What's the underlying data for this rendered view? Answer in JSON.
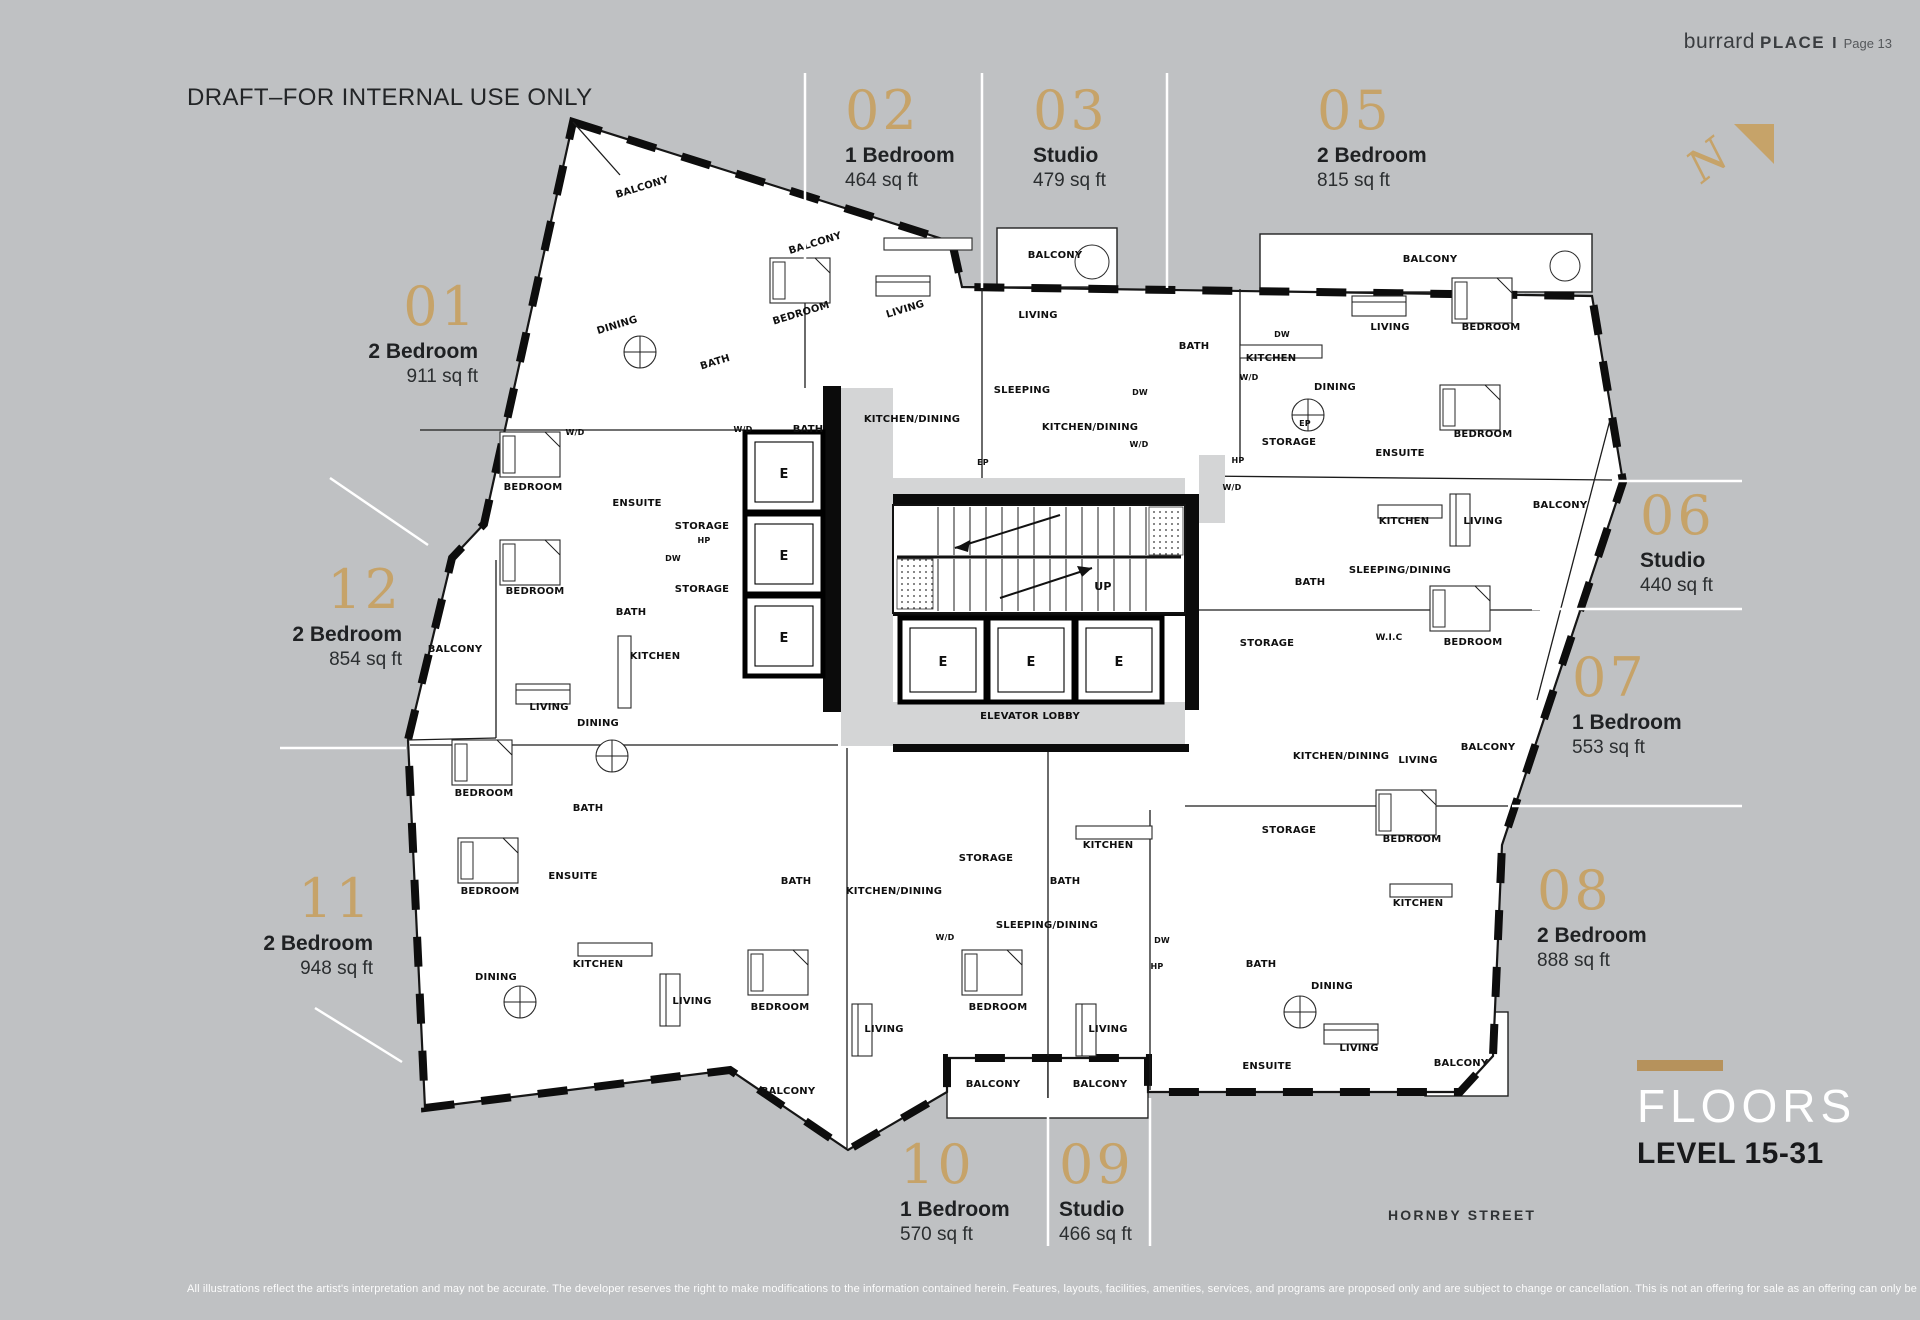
{
  "page": {
    "brand": {
      "light": "burrard",
      "bold": "PLACE",
      "sep": "I",
      "page_label": "Page 13"
    },
    "draft_notice": "DRAFT–FOR INTERNAL USE ONLY",
    "street_label": "HORNBY STREET",
    "floors": {
      "title": "FLOORS",
      "subtitle": "LEVEL 15-31"
    },
    "disclaimer": "All illustrations reflect the artist's interpretation and may not be accurate. The developer reserves the right to make modifications to the information contained herein. Features, layouts, facilities, amenities, services, and programs are proposed only and are subject to change or cancellation. This is not an offering for sale as an offering can only be made by disclosure statement. E.&O.E.",
    "colors": {
      "background": "#bfc1c3",
      "gold": "#c6a369",
      "ink": "#161616",
      "plan_fill": "#ffffff",
      "corridor": "#d4d5d6",
      "floors_bar": "#b6925c"
    }
  },
  "units": [
    {
      "number": "01",
      "type": "2 Bedroom",
      "area": "911 sq ft"
    },
    {
      "number": "02",
      "type": "1 Bedroom",
      "area": "464 sq ft"
    },
    {
      "number": "03",
      "type": "Studio",
      "area": "479 sq ft"
    },
    {
      "number": "05",
      "type": "2 Bedroom",
      "area": "815 sq ft"
    },
    {
      "number": "06",
      "type": "Studio",
      "area": "440 sq ft"
    },
    {
      "number": "07",
      "type": "1 Bedroom",
      "area": "553 sq ft"
    },
    {
      "number": "08",
      "type": "2 Bedroom",
      "area": "888 sq ft"
    },
    {
      "number": "09",
      "type": "Studio",
      "area": "466 sq ft"
    },
    {
      "number": "10",
      "type": "1 Bedroom",
      "area": "570 sq ft"
    },
    {
      "number": "11",
      "type": "2 Bedroom",
      "area": "948 sq ft"
    },
    {
      "number": "12",
      "type": "2 Bedroom",
      "area": "854 sq ft"
    }
  ],
  "plan": {
    "north_label": "N",
    "room_labels": [
      {
        "t": "BALCONY",
        "x": 643,
        "y": 190,
        "r": -17
      },
      {
        "t": "BALCONY",
        "x": 816,
        "y": 246,
        "r": -17
      },
      {
        "t": "BALCONY",
        "x": 1055,
        "y": 258
      },
      {
        "t": "BALCONY",
        "x": 1430,
        "y": 262
      },
      {
        "t": "BALCONY",
        "x": 1560,
        "y": 508
      },
      {
        "t": "BALCONY",
        "x": 1488,
        "y": 750
      },
      {
        "t": "BALCONY",
        "x": 455,
        "y": 652
      },
      {
        "t": "BALCONY",
        "x": 788,
        "y": 1094
      },
      {
        "t": "BALCONY",
        "x": 993,
        "y": 1087
      },
      {
        "t": "BALCONY",
        "x": 1100,
        "y": 1087
      },
      {
        "t": "BALCONY",
        "x": 1461,
        "y": 1066
      },
      {
        "t": "BEDROOM",
        "x": 802,
        "y": 316,
        "r": -17
      },
      {
        "t": "BEDROOM",
        "x": 1491,
        "y": 330
      },
      {
        "t": "BEDROOM",
        "x": 1483,
        "y": 437
      },
      {
        "t": "BEDROOM",
        "x": 533,
        "y": 490
      },
      {
        "t": "BEDROOM",
        "x": 535,
        "y": 594
      },
      {
        "t": "BEDROOM",
        "x": 1473,
        "y": 645
      },
      {
        "t": "BEDROOM",
        "x": 484,
        "y": 796
      },
      {
        "t": "BEDROOM",
        "x": 490,
        "y": 894
      },
      {
        "t": "BEDROOM",
        "x": 1412,
        "y": 842
      },
      {
        "t": "BEDROOM",
        "x": 780,
        "y": 1010
      },
      {
        "t": "BEDROOM",
        "x": 998,
        "y": 1010
      },
      {
        "t": "LIVING",
        "x": 906,
        "y": 312,
        "r": -17
      },
      {
        "t": "LIVING",
        "x": 1038,
        "y": 318
      },
      {
        "t": "LIVING",
        "x": 1390,
        "y": 330
      },
      {
        "t": "LIVING",
        "x": 1483,
        "y": 524
      },
      {
        "t": "LIVING",
        "x": 549,
        "y": 710
      },
      {
        "t": "LIVING",
        "x": 1418,
        "y": 763
      },
      {
        "t": "LIVING",
        "x": 692,
        "y": 1004
      },
      {
        "t": "LIVING",
        "x": 884,
        "y": 1032
      },
      {
        "t": "LIVING",
        "x": 1108,
        "y": 1032
      },
      {
        "t": "LIVING",
        "x": 1359,
        "y": 1051
      },
      {
        "t": "KITCHEN",
        "x": 1271,
        "y": 361
      },
      {
        "t": "KITCHEN",
        "x": 1404,
        "y": 524
      },
      {
        "t": "KITCHEN",
        "x": 655,
        "y": 659
      },
      {
        "t": "KITCHEN",
        "x": 598,
        "y": 967
      },
      {
        "t": "KITCHEN",
        "x": 1108,
        "y": 848
      },
      {
        "t": "KITCHEN",
        "x": 1418,
        "y": 906
      },
      {
        "t": "DINING",
        "x": 618,
        "y": 328,
        "r": -17
      },
      {
        "t": "DINING",
        "x": 1335,
        "y": 390
      },
      {
        "t": "DINING",
        "x": 598,
        "y": 726
      },
      {
        "t": "DINING",
        "x": 496,
        "y": 980
      },
      {
        "t": "DINING",
        "x": 1332,
        "y": 989
      },
      {
        "t": "KITCHEN/DINING",
        "x": 912,
        "y": 422
      },
      {
        "t": "KITCHEN/DINING",
        "x": 1090,
        "y": 430
      },
      {
        "t": "KITCHEN/DINING",
        "x": 1341,
        "y": 759
      },
      {
        "t": "KITCHEN/DINING",
        "x": 894,
        "y": 894
      },
      {
        "t": "SLEEPING",
        "x": 1022,
        "y": 393
      },
      {
        "t": "SLEEPING/DINING",
        "x": 1400,
        "y": 573
      },
      {
        "t": "SLEEPING/DINING",
        "x": 1047,
        "y": 928
      },
      {
        "t": "BATH",
        "x": 716,
        "y": 365,
        "r": -17
      },
      {
        "t": "BATH",
        "x": 808,
        "y": 432
      },
      {
        "t": "BATH",
        "x": 1194,
        "y": 349
      },
      {
        "t": "BATH",
        "x": 1310,
        "y": 585
      },
      {
        "t": "BATH",
        "x": 631,
        "y": 615
      },
      {
        "t": "BATH",
        "x": 588,
        "y": 811
      },
      {
        "t": "BATH",
        "x": 796,
        "y": 884
      },
      {
        "t": "BATH",
        "x": 1065,
        "y": 884
      },
      {
        "t": "BATH",
        "x": 1261,
        "y": 967
      },
      {
        "t": "ENSUITE",
        "x": 637,
        "y": 506
      },
      {
        "t": "ENSUITE",
        "x": 1400,
        "y": 456
      },
      {
        "t": "ENSUITE",
        "x": 573,
        "y": 879
      },
      {
        "t": "ENSUITE",
        "x": 1267,
        "y": 1069
      },
      {
        "t": "STORAGE",
        "x": 702,
        "y": 529
      },
      {
        "t": "STORAGE",
        "x": 702,
        "y": 592
      },
      {
        "t": "STORAGE",
        "x": 1289,
        "y": 445
      },
      {
        "t": "STORAGE",
        "x": 1267,
        "y": 646
      },
      {
        "t": "STORAGE",
        "x": 986,
        "y": 861
      },
      {
        "t": "STORAGE",
        "x": 1289,
        "y": 833
      },
      {
        "t": "W/D",
        "x": 575,
        "y": 435,
        "s": 8
      },
      {
        "t": "W/D",
        "x": 743,
        "y": 432,
        "s": 8
      },
      {
        "t": "W/D",
        "x": 1139,
        "y": 447,
        "s": 8
      },
      {
        "t": "W/D",
        "x": 1249,
        "y": 380,
        "s": 8
      },
      {
        "t": "W/D",
        "x": 1232,
        "y": 490,
        "s": 8
      },
      {
        "t": "W/D",
        "x": 945,
        "y": 940,
        "s": 8
      },
      {
        "t": "DW",
        "x": 1282,
        "y": 337,
        "s": 8
      },
      {
        "t": "DW",
        "x": 1140,
        "y": 395,
        "s": 8
      },
      {
        "t": "DW",
        "x": 673,
        "y": 561,
        "s": 8
      },
      {
        "t": "DW",
        "x": 1162,
        "y": 943,
        "s": 8
      },
      {
        "t": "HP",
        "x": 704,
        "y": 543,
        "s": 8
      },
      {
        "t": "HP",
        "x": 1238,
        "y": 463,
        "s": 8
      },
      {
        "t": "HP",
        "x": 1157,
        "y": 969,
        "s": 8
      },
      {
        "t": "EP",
        "x": 1305,
        "y": 426,
        "s": 8
      },
      {
        "t": "EP",
        "x": 983,
        "y": 465,
        "s": 8
      },
      {
        "t": "W.I.C",
        "x": 1389,
        "y": 640,
        "s": 9
      },
      {
        "t": "UP",
        "x": 1103,
        "y": 590,
        "s": 11
      },
      {
        "t": "ELEVATOR LOBBY",
        "x": 1030,
        "y": 719,
        "s": 10
      },
      {
        "t": "E",
        "x": 784,
        "y": 478,
        "s": 13
      },
      {
        "t": "E",
        "x": 784,
        "y": 560,
        "s": 13
      },
      {
        "t": "E",
        "x": 784,
        "y": 642,
        "s": 13
      },
      {
        "t": "E",
        "x": 943,
        "y": 666,
        "s": 13
      },
      {
        "t": "E",
        "x": 1031,
        "y": 666,
        "s": 13
      },
      {
        "t": "E",
        "x": 1119,
        "y": 666,
        "s": 13
      }
    ]
  }
}
